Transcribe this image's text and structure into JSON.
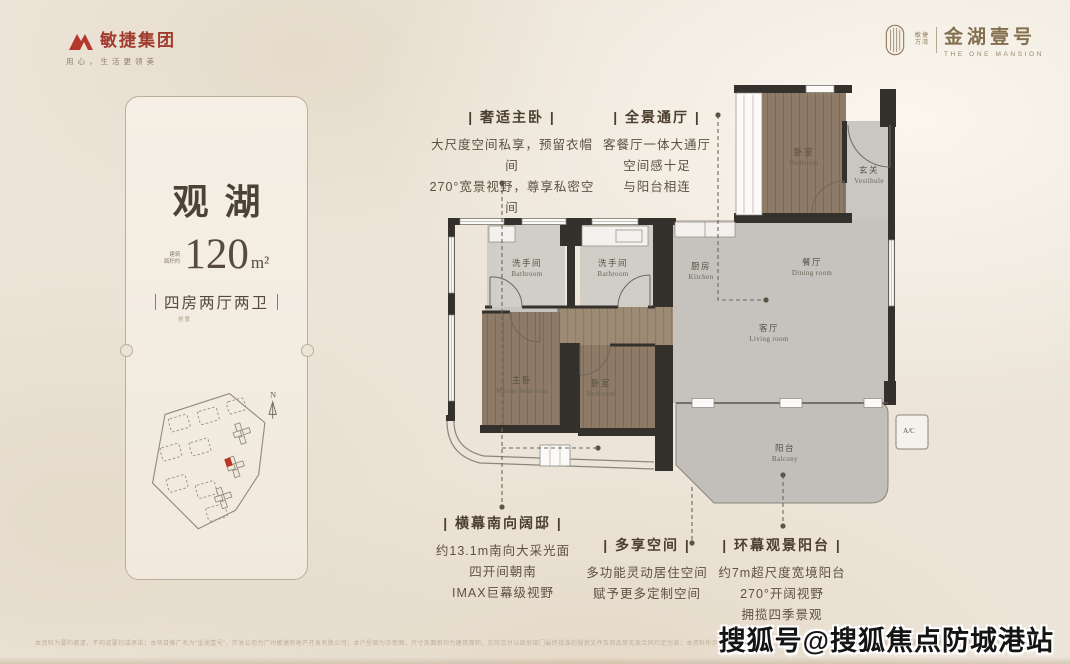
{
  "brand_left": {
    "name": "敏捷集团",
    "tagline": "用心，生活更领美"
  },
  "brand_right": {
    "dev_line1": "敏捷",
    "dev_line2": "万湾",
    "name": "金湖壹号",
    "name_en": "THE ONE MANSION"
  },
  "card": {
    "title": "观湖",
    "area_label_line1": "建筑",
    "area_label_line2": "面积约",
    "area_value": "120",
    "area_unit": "m²",
    "layout": "四房两厅两卫",
    "layout_note": "创意",
    "compass": "N"
  },
  "callouts": {
    "master": {
      "title": "| 奢适主卧 |",
      "line1": "大尺度空间私享，预留衣帽间",
      "line2": "270°宽景视野，尊享私密空间"
    },
    "hall": {
      "title": "| 全景通厅 |",
      "line1": "客餐厅一体大通厅",
      "line2": "空间感十足",
      "line3": "与阳台相连"
    },
    "south": {
      "title": "| 横幕南向阔邸 |",
      "line1": "约13.1m南向大采光面",
      "line2": "四开间朝南",
      "line3": "IMAX巨幕级视野"
    },
    "flex": {
      "title": "| 多享空间 |",
      "line1": "多功能灵动居住空间",
      "line2": "赋予更多定制空间"
    },
    "view": {
      "title": "| 环幕观景阳台 |",
      "line1": "约7m超尺度宽境阳台",
      "line2": "270°开阔视野",
      "line3": "拥揽四季景观"
    }
  },
  "rooms": {
    "bath1": {
      "cn": "洗手间",
      "en": "Bathroom"
    },
    "bath2": {
      "cn": "洗手间",
      "en": "Bathroom"
    },
    "kitchen": {
      "cn": "厨房",
      "en": "Kitchen"
    },
    "dining": {
      "cn": "餐厅",
      "en": "Dining room"
    },
    "living": {
      "cn": "客厅",
      "en": "Living room"
    },
    "vestibule": {
      "cn": "玄关",
      "en": "Vestibule"
    },
    "bed_top": {
      "cn": "卧室",
      "en": "Bedroom"
    },
    "master": {
      "cn": "主卧",
      "en": "Master bedroom"
    },
    "bed2": {
      "cn": "卧室",
      "en": "Bedroom"
    },
    "balcony": {
      "cn": "阳台",
      "en": "Balcony"
    },
    "ac_label": "A/C"
  },
  "footer": {
    "disclaimer": "本资料为要约邀请，不构成要约或承诺；本项目推广名为“金湖壹号”，开发公司为广州敏捷房地产开发有限公司；本户型图为示意图，尺寸及面积均为建筑面积，实际交付以政府部门最终批准的规划文件及商品房买卖合同约定为准；本资料所示装修、家具、陈设仅为示意，不作为交付标准；不排除因政府规划、规定及开发商未能控制的原因而发生变化，敬请留意最新资料；详情请咨询营销中心。",
    "watermark": "搜狐号@搜狐焦点防城港站"
  },
  "colors": {
    "accent_red": "#b5382c",
    "bronze": "#8a7454",
    "wall": "#34302b",
    "wood": "#8d7a67",
    "floor": "#c6c3be",
    "background": "#ece4d8"
  }
}
